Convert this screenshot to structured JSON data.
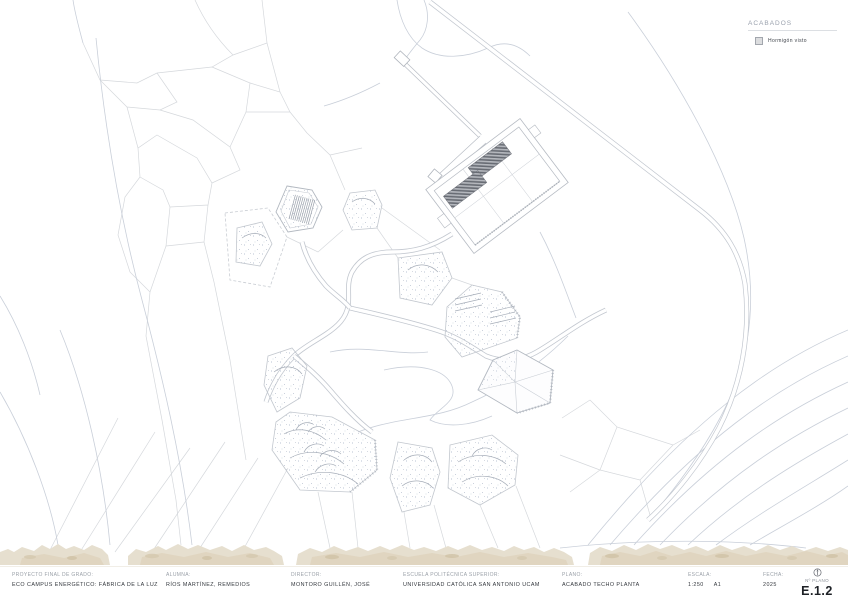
{
  "legend": {
    "title": "ACABADOS",
    "items": [
      {
        "label": "Hormigón visto",
        "swatch_color": "#dcdddf"
      }
    ]
  },
  "title_block": {
    "fields": [
      {
        "label": "PROYECTO FINAL DE GRADO:",
        "value": "ECO CAMPUS ENERGÉTICO: FÁBRICA DE LA LUZ"
      },
      {
        "label": "ALUMNA:",
        "value": "RÍOS MARTÍNEZ, REMEDIOS"
      },
      {
        "label": "DIRECTOR:",
        "value": "MONTORO GUILLÉN, JOSÉ"
      },
      {
        "label": "ESCUELA POLITÉCNICA SUPERIOR:",
        "value": "UNIVERSIDAD CATÓLICA SAN ANTONIO UCAM"
      },
      {
        "label": "PLANO:",
        "value": "ACABADO TECHO PLANTA"
      },
      {
        "label": "ESCALA:",
        "value": "1:250",
        "extra": "A1"
      },
      {
        "label": "FECHA:",
        "value": "2025"
      },
      {
        "label": "Nº PLANO",
        "value": "E.1.2"
      }
    ]
  },
  "colors": {
    "parcel_line": "#d5d8dc",
    "contour_line": "#c9cfd9",
    "roof_hatch_dark": "#686c74",
    "stipple_dot": "#a9b5c9",
    "terrain_band": "#e6dfcf",
    "terrain_speckle": "#d5c9af"
  }
}
